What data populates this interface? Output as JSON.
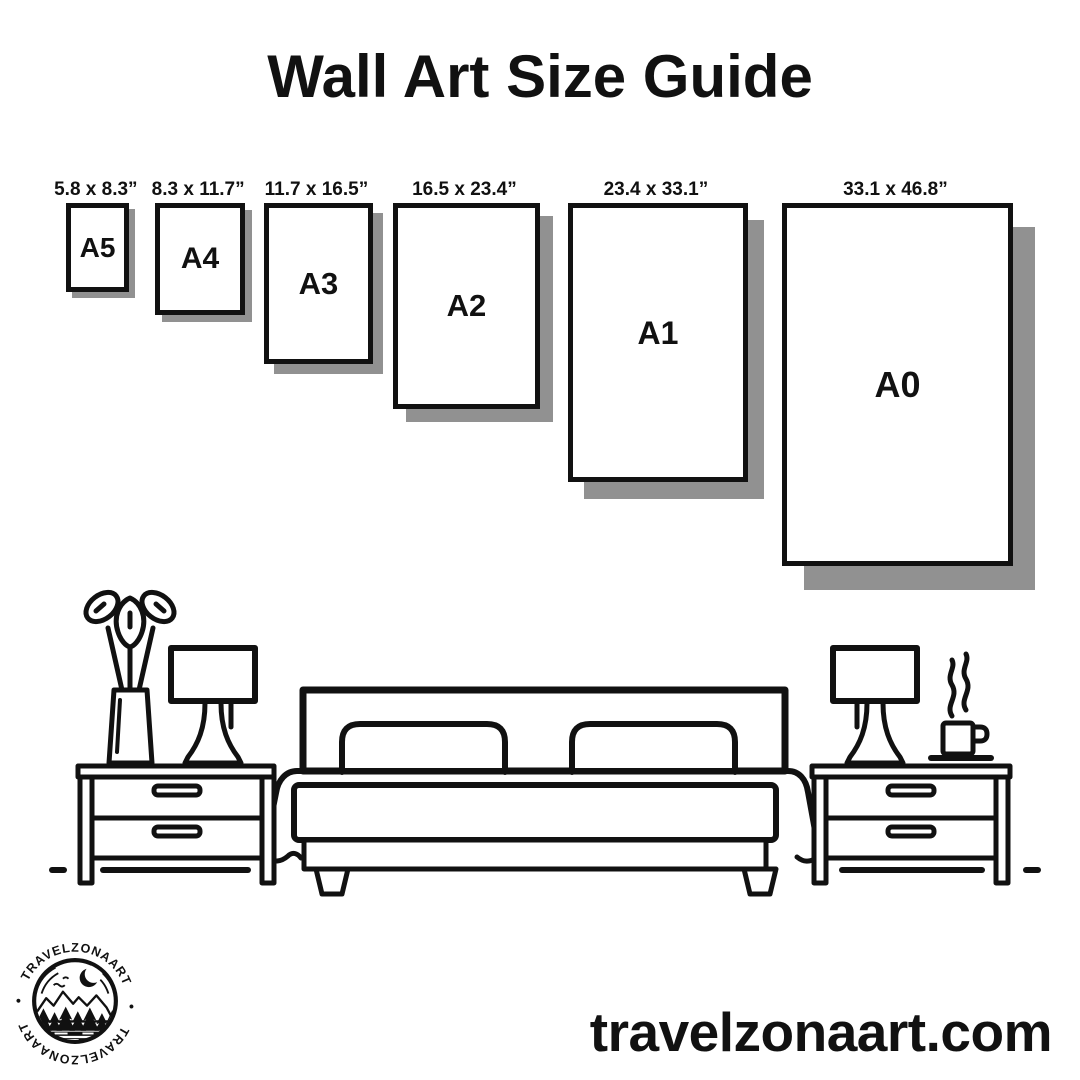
{
  "title": "Wall Art Size Guide",
  "colors": {
    "ink": "#111111",
    "paper": "#ffffff",
    "shadow": "#919191"
  },
  "sizes": [
    {
      "code": "A5",
      "dims": "5.8 x 8.3”"
    },
    {
      "code": "A4",
      "dims": "8.3 x 11.7”"
    },
    {
      "code": "A3",
      "dims": "11.7 x 16.5”"
    },
    {
      "code": "A2",
      "dims": "16.5 x 23.4”"
    },
    {
      "code": "A1",
      "dims": "23.4 x 33.1”"
    },
    {
      "code": "A0",
      "dims": "33.1 x 46.8”"
    }
  ],
  "scene": {
    "items": [
      "vase-plant",
      "table-lamp",
      "nightstand",
      "double-bed",
      "nightstand",
      "table-lamp",
      "coffee-cup"
    ]
  },
  "logo": {
    "brand_top": "TRAVELZONAART",
    "brand_bottom": "TRAVELZONAART",
    "separator": "•"
  },
  "footer": {
    "website": "travelzonaart.com"
  }
}
